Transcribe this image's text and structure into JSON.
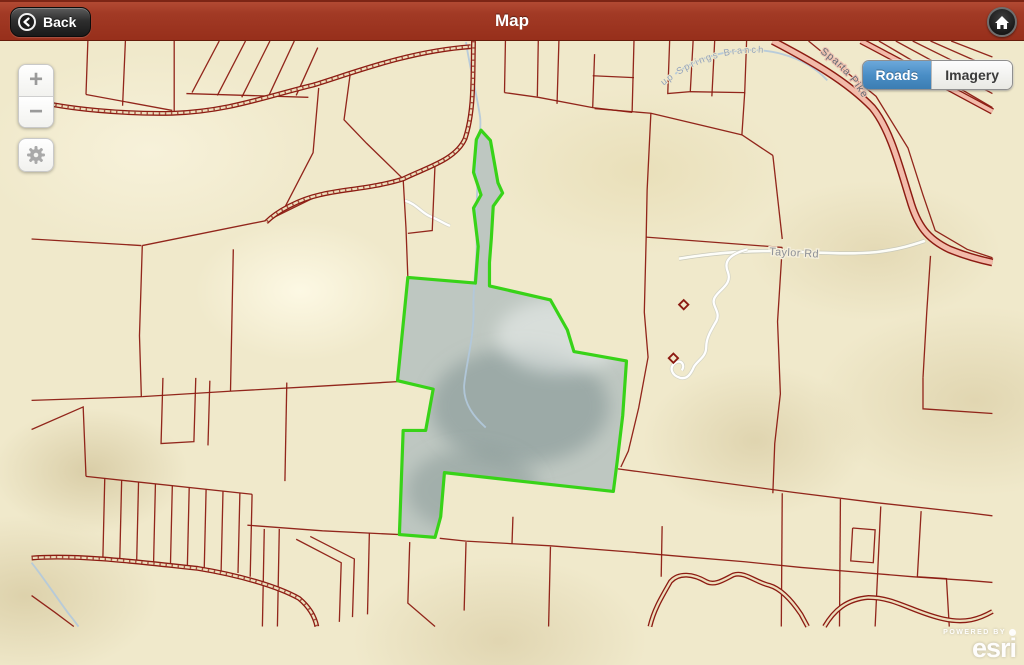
{
  "header": {
    "title": "Map",
    "back_label": "Back"
  },
  "map_controls": {
    "zoom_in": "+",
    "zoom_out": "−"
  },
  "basemap_toggle": {
    "roads": "Roads",
    "imagery": "Imagery",
    "selected": "Roads"
  },
  "map_labels": {
    "road_minor": "Taylor Rd",
    "road_major": "Sparta Pike",
    "stream": "up Springs Branch"
  },
  "attribution": {
    "powered_by": "POWERED BY",
    "brand": "esri"
  },
  "icons": {
    "back": "chevron-left",
    "home": "house",
    "locate": "gear"
  },
  "colors": {
    "header_bg": "#a23a25",
    "selected_segment": "#4a8ec6",
    "parcel_line": "#8c1b12",
    "highlight_outline": "#38d318",
    "highlight_fill": "#b6c1bf",
    "highway_fill": "#f2bbaa",
    "stream": "#b3c9dc",
    "basemap": "#f0e9cb"
  }
}
